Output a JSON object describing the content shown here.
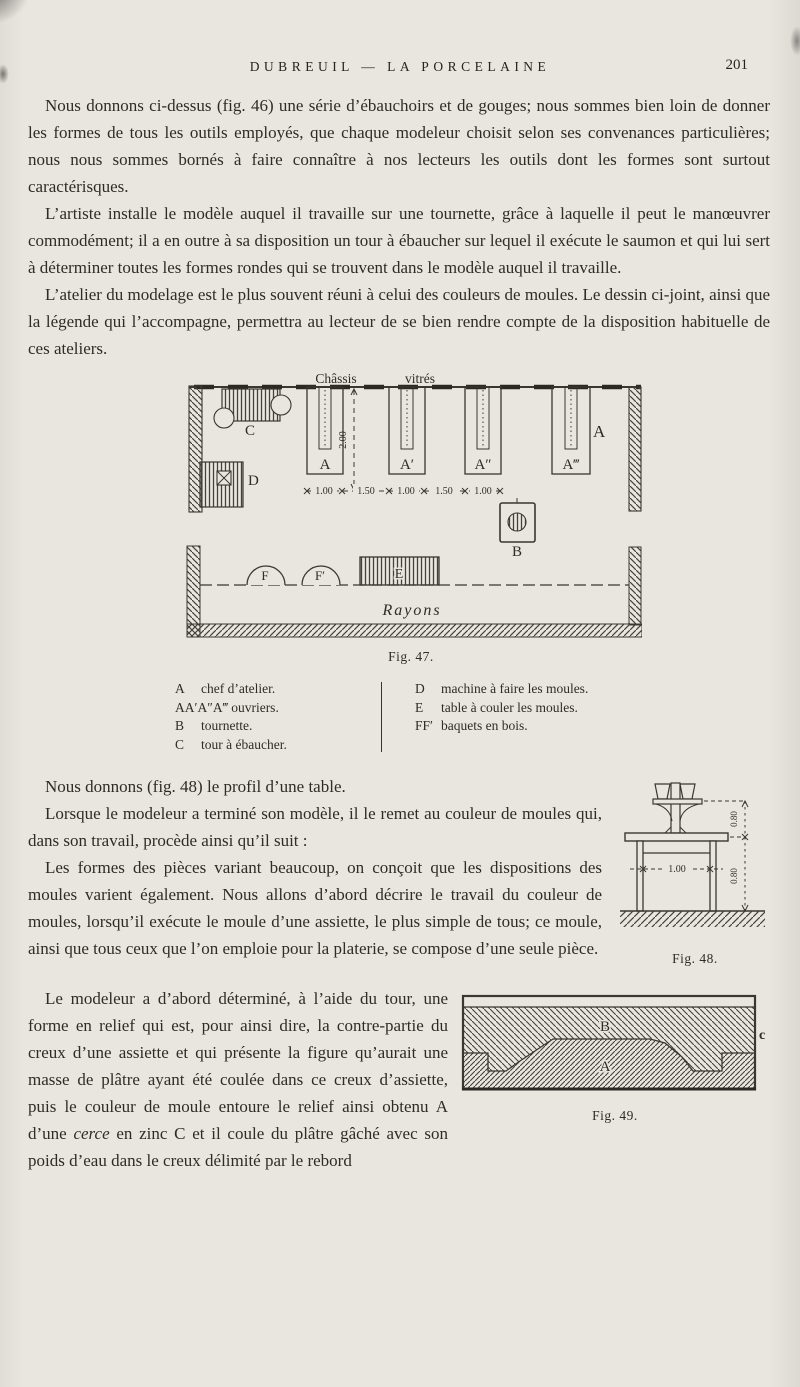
{
  "header": {
    "title": "DUBREUIL — LA PORCELAINE",
    "page_number": "201"
  },
  "paragraphs": {
    "p1": "Nous donnons ci-dessus (fig. 46) une série d’ébauchoirs et de gouges; nous sommes bien loin de donner les formes de tous les outils employés, que chaque modeleur choisit selon ses convenances particulières; nous nous sommes bornés à faire connaître à nos lecteurs les outils dont les formes sont surtout caractérisques.",
    "p2": "L’artiste installe le modèle auquel il travaille sur une tournette, grâce à laquelle il peut le manœuvrer commodément; il a en outre à sa disposition un tour à ébaucher sur lequel il exécute le saumon et qui lui sert à déterminer toutes les formes rondes qui se trouvent dans le modèle auquel il travaille.",
    "p3": "L’atelier du modelage est le plus souvent réuni à celui des couleurs de moules. Le dessin ci-joint, ainsi que la légende qui l’accompagne, permettra au lecteur de se bien rendre compte de la disposition habituelle de ces ateliers.",
    "p4": "Nous donnons (fig. 48) le profil d’une table.",
    "p5": "Lorsque le modeleur a terminé son modèle, il le remet au couleur de moules qui, dans son travail, procède ainsi qu’il suit :",
    "p6": "Les formes des pièces variant beaucoup, on conçoit que les dispositions des moules varient également. Nous allons d’abord décrire le travail du couleur de moules, lorsqu’il exécute le moule d’une assiette, le plus simple de tous; ce moule, ainsi que tous ceux que l’on emploie pour la platerie, se compose d’une seule pièce.",
    "p7_before": "Le modeleur a d’abord déterminé, à l’aide du tour, une forme en relief qui est, pour ainsi dire, la contre-partie du creux d’une assiette et qui présente la figure qu’aurait une masse de plâtre ayant été coulée dans ce creux d’assiette, puis le couleur de moule entoure le relief ainsi obtenu A d’une ",
    "p7_italic": "cerce",
    "p7_after": " en zinc C et il coule du plâtre gâché avec son poids d’eau dans le creux délimité par le rebord"
  },
  "fig47": {
    "caption": "Fig. 47.",
    "wall_label_1": "Châssis",
    "wall_label_2": "vitrés",
    "table_labels": [
      "A",
      "A′",
      "A″",
      "A‴"
    ],
    "label_right_a": "A",
    "label_b": "B",
    "label_c": "C",
    "label_d": "D",
    "label_e": "E",
    "label_f": "F",
    "label_f2": "F′",
    "label_rayons": "Rayons",
    "dim_vertical": "2.00",
    "dims_horizontal": [
      "1.00",
      "1.50",
      "1.00",
      "1.50",
      "1.00"
    ]
  },
  "legend": {
    "left": [
      {
        "key": "A",
        "desc": "chef d’atelier."
      },
      {
        "key": "AA′A″A‴",
        "desc": "ouvriers."
      },
      {
        "key": "B",
        "desc": "tournette."
      },
      {
        "key": "C",
        "desc": "tour à ébaucher."
      }
    ],
    "right": [
      {
        "key": "D",
        "desc": "machine à faire les moules."
      },
      {
        "key": "E",
        "desc": "table à couler les moules."
      },
      {
        "key": "FF′",
        "desc": "baquets en bois."
      }
    ]
  },
  "fig48": {
    "caption": "Fig. 48.",
    "dim_width": "1.00",
    "dim_height_top": "0.80",
    "dim_height_bottom": "0.80"
  },
  "fig49": {
    "caption": "Fig. 49.",
    "label_top": "B",
    "label_bottom": "A",
    "label_side": "c"
  },
  "colors": {
    "paper": "#e9e6e0",
    "ink": "#2f2b26",
    "line": "#3b362f"
  }
}
